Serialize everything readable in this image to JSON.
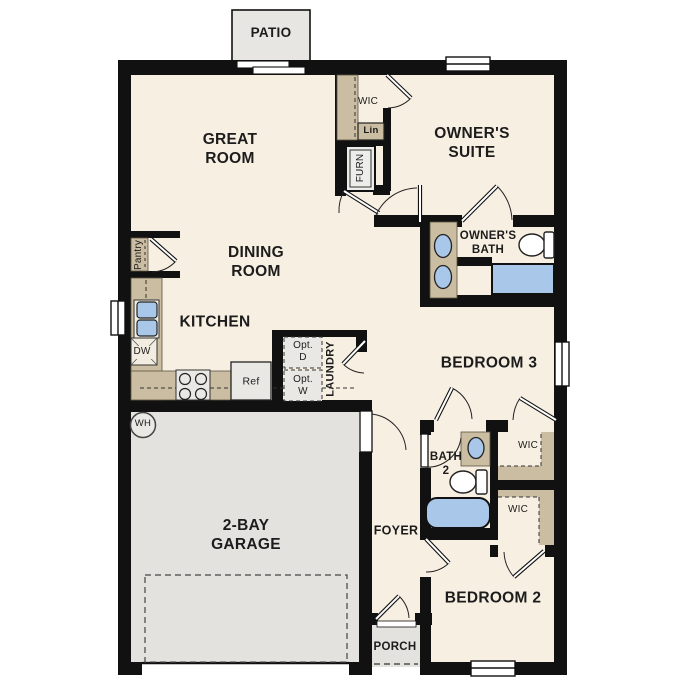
{
  "plan": {
    "title": "single-story floor plan",
    "colors": {
      "floor_cream": "#f7efe2",
      "hard_surface_gray": "#e3e2df",
      "wall_black": "#111111",
      "cabinetry_tan": "#cbbda1",
      "plumbing_blue": "#a9c7e8",
      "appliance_gray": "#e9e8e5"
    },
    "labels": {
      "patio": "PATIO",
      "great_room": "GREAT\nROOM",
      "wic_owner": "WIC",
      "lin": "Lin",
      "furn": "FURN",
      "owners_suite": "OWNER'S\nSUITE",
      "owners_bath": "OWNER'S\nBATH",
      "pantry": "Pantry",
      "dining_room": "DINING\nROOM",
      "kitchen": "KITCHEN",
      "dw": "DW",
      "ref": "Ref",
      "opt_d": "Opt.\nD",
      "opt_w": "Opt.\nW",
      "laundry": "LAUNDRY",
      "bedroom3": "BEDROOM 3",
      "wh": "WH",
      "garage": "2-BAY\nGARAGE",
      "bath2": "BATH\n2",
      "wic_bed3": "WIC",
      "wic_bed2": "WIC",
      "foyer": "FOYER",
      "bedroom2": "BEDROOM 2",
      "porch": "PORCH"
    }
  }
}
